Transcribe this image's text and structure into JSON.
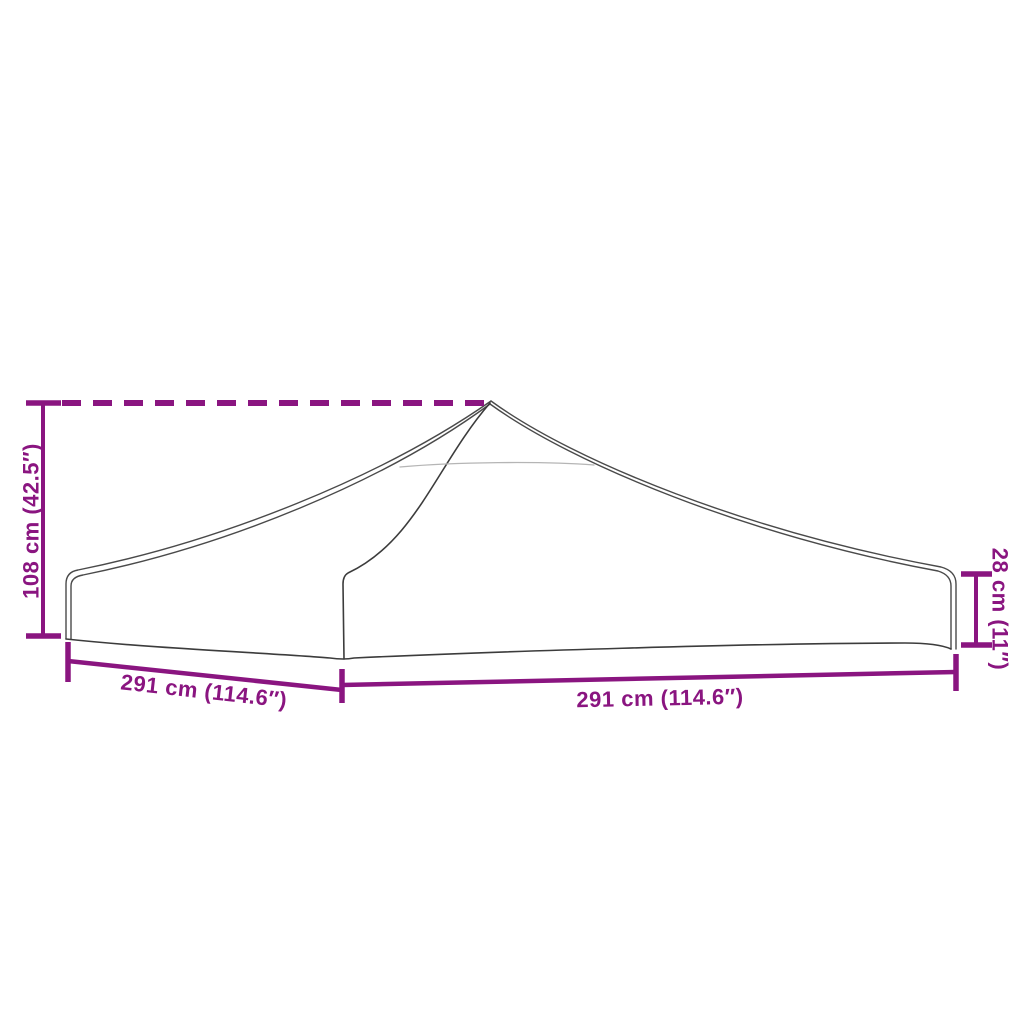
{
  "diagram": {
    "type": "product-dimension-diagram",
    "subject": "party-tent roof canopy top with valance",
    "labels": {
      "height_total": "108 cm (42.5″)",
      "width_left": "291 cm (114.6″)",
      "width_right": "291 cm (114.6″)",
      "valance_height": "28 cm (11″)"
    },
    "colors": {
      "dimension": "#8A1580",
      "outline": "#4a4a4a",
      "outline_dark": "#3c3c3c",
      "outline_light": "#b5b5b5",
      "background": "#ffffff"
    }
  }
}
